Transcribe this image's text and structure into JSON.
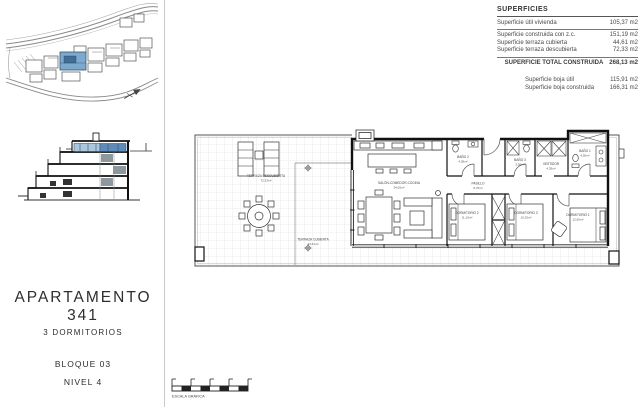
{
  "colors": {
    "highlight_blue": "#7fa9cc",
    "highlight_blue_dark": "#3f6e99",
    "glazing_light": "#aac7dd",
    "glazing_dark": "#5e8cb8",
    "line_dark": "#111111"
  },
  "superficies": {
    "title": "SUPERFICIES",
    "rows": [
      {
        "label": "Superficie útil vivienda",
        "value": "105,37 m2"
      },
      {
        "label": "Superficie construida con z.c.",
        "value": "151,19 m2"
      },
      {
        "label": "Superficie terraza cubierta",
        "value": "44,61 m2"
      },
      {
        "label": "Superficie terraza descubierta",
        "value": "72,33 m2"
      }
    ],
    "total_label": "SUPERFICIE TOTAL CONSTRUIDA",
    "total_value": "268,13 m2",
    "extra_rows": [
      {
        "label": "Superficie boja útil",
        "value": "115,91 m2"
      },
      {
        "label": "Superficie boja construida",
        "value": "166,31 m2"
      }
    ]
  },
  "title_block": {
    "apartment": "APARTAMENTO 341",
    "bedrooms": "3 DORMITORIOS",
    "block": "BLOQUE 03",
    "level": "NIVEL 4"
  },
  "plan": {
    "rooms": [
      {
        "name": "TERRAZA DESCUBIERTA",
        "area": "72,33m²"
      },
      {
        "name": "TERRAZA CUBIERTA",
        "area": "44,61m²"
      },
      {
        "name": "SALÓN-COMEDOR-COCINA",
        "area": "34,05m²"
      },
      {
        "name": "BAÑO 2",
        "area": "4,05m²"
      },
      {
        "name": "PASILLO",
        "area": "8,70m²"
      },
      {
        "name": "BAÑO 3",
        "area": "3,55m²"
      },
      {
        "name": "VESTIDOR",
        "area": "4,35m²"
      },
      {
        "name": "BAÑO 1",
        "area": "4,50m²"
      },
      {
        "name": "DORMITORIO 2",
        "area": "11,10m²"
      },
      {
        "name": "DORMITORIO 3",
        "area": "10,25m²"
      },
      {
        "name": "DORMITORIO 1",
        "area": "12,60m²"
      }
    ]
  },
  "scale_bar": {
    "label": "ESCALA GRÁFICA"
  }
}
